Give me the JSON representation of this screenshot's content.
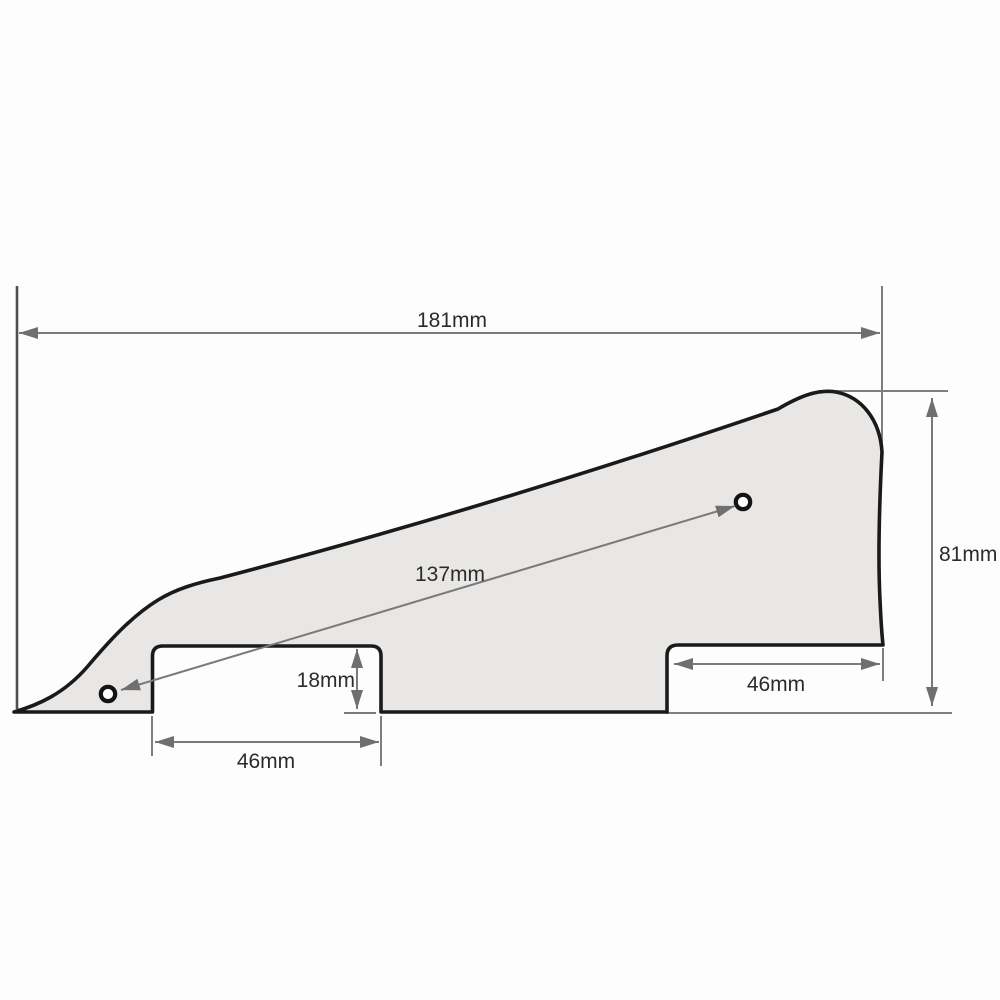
{
  "diagram": {
    "kind": "technical dimension drawing",
    "subject": "guitar pickguard outline with two pickup cutouts and two screw holes",
    "units": "mm",
    "colors": {
      "background": "#fdfdfd",
      "part_fill": "#e8e7e5",
      "part_outline": "#1a1a1a",
      "dimension_line": "#7a7a7a",
      "arrow": "#6f6f6f",
      "text": "#2b2b2b"
    },
    "labels": {
      "overall_width": "181mm",
      "overall_height": "81mm",
      "hole_spacing": "137mm",
      "cutout_depth": "18mm",
      "left_cutout_width": "46mm",
      "right_cutout_width": "46mm"
    },
    "values": {
      "overall_width_mm": 181,
      "overall_height_mm": 81,
      "hole_spacing_mm": 137,
      "cutout_depth_mm": 18,
      "left_cutout_width_mm": 46,
      "right_cutout_width_mm": 46
    },
    "features": {
      "screw_hole_count": 2,
      "pickup_cutout_count": 2
    }
  }
}
